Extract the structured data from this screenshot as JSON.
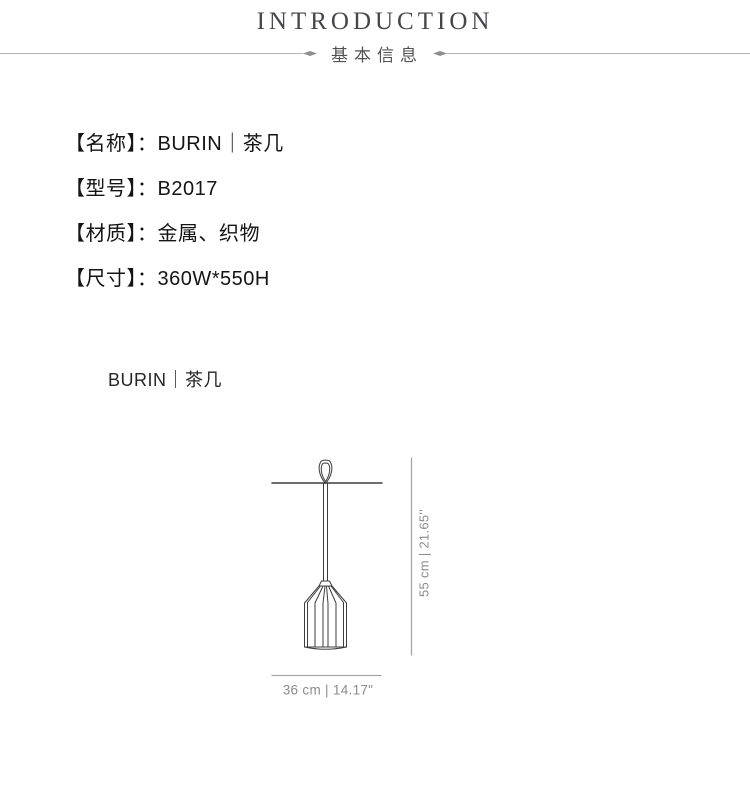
{
  "header": {
    "title": "INTRODUCTION",
    "subtitle": "基本信息"
  },
  "specs": {
    "items": [
      "【名称】：BURIN｜茶几",
      "【型号】：B2017",
      "【材质】：金属、织物",
      "【尺寸】：360W*550H"
    ]
  },
  "product": {
    "label": "BURIN｜茶几"
  },
  "diagram": {
    "height_label": "55 cm | 21.65''",
    "width_label": "36 cm | 14.17\""
  },
  "colors": {
    "title_gray": "#46464d",
    "text_black": "#141414",
    "drawing_line": "#3d3d3d",
    "dimension_gray": "#8c8c8c",
    "divider_gray": "#b3b3b3"
  }
}
